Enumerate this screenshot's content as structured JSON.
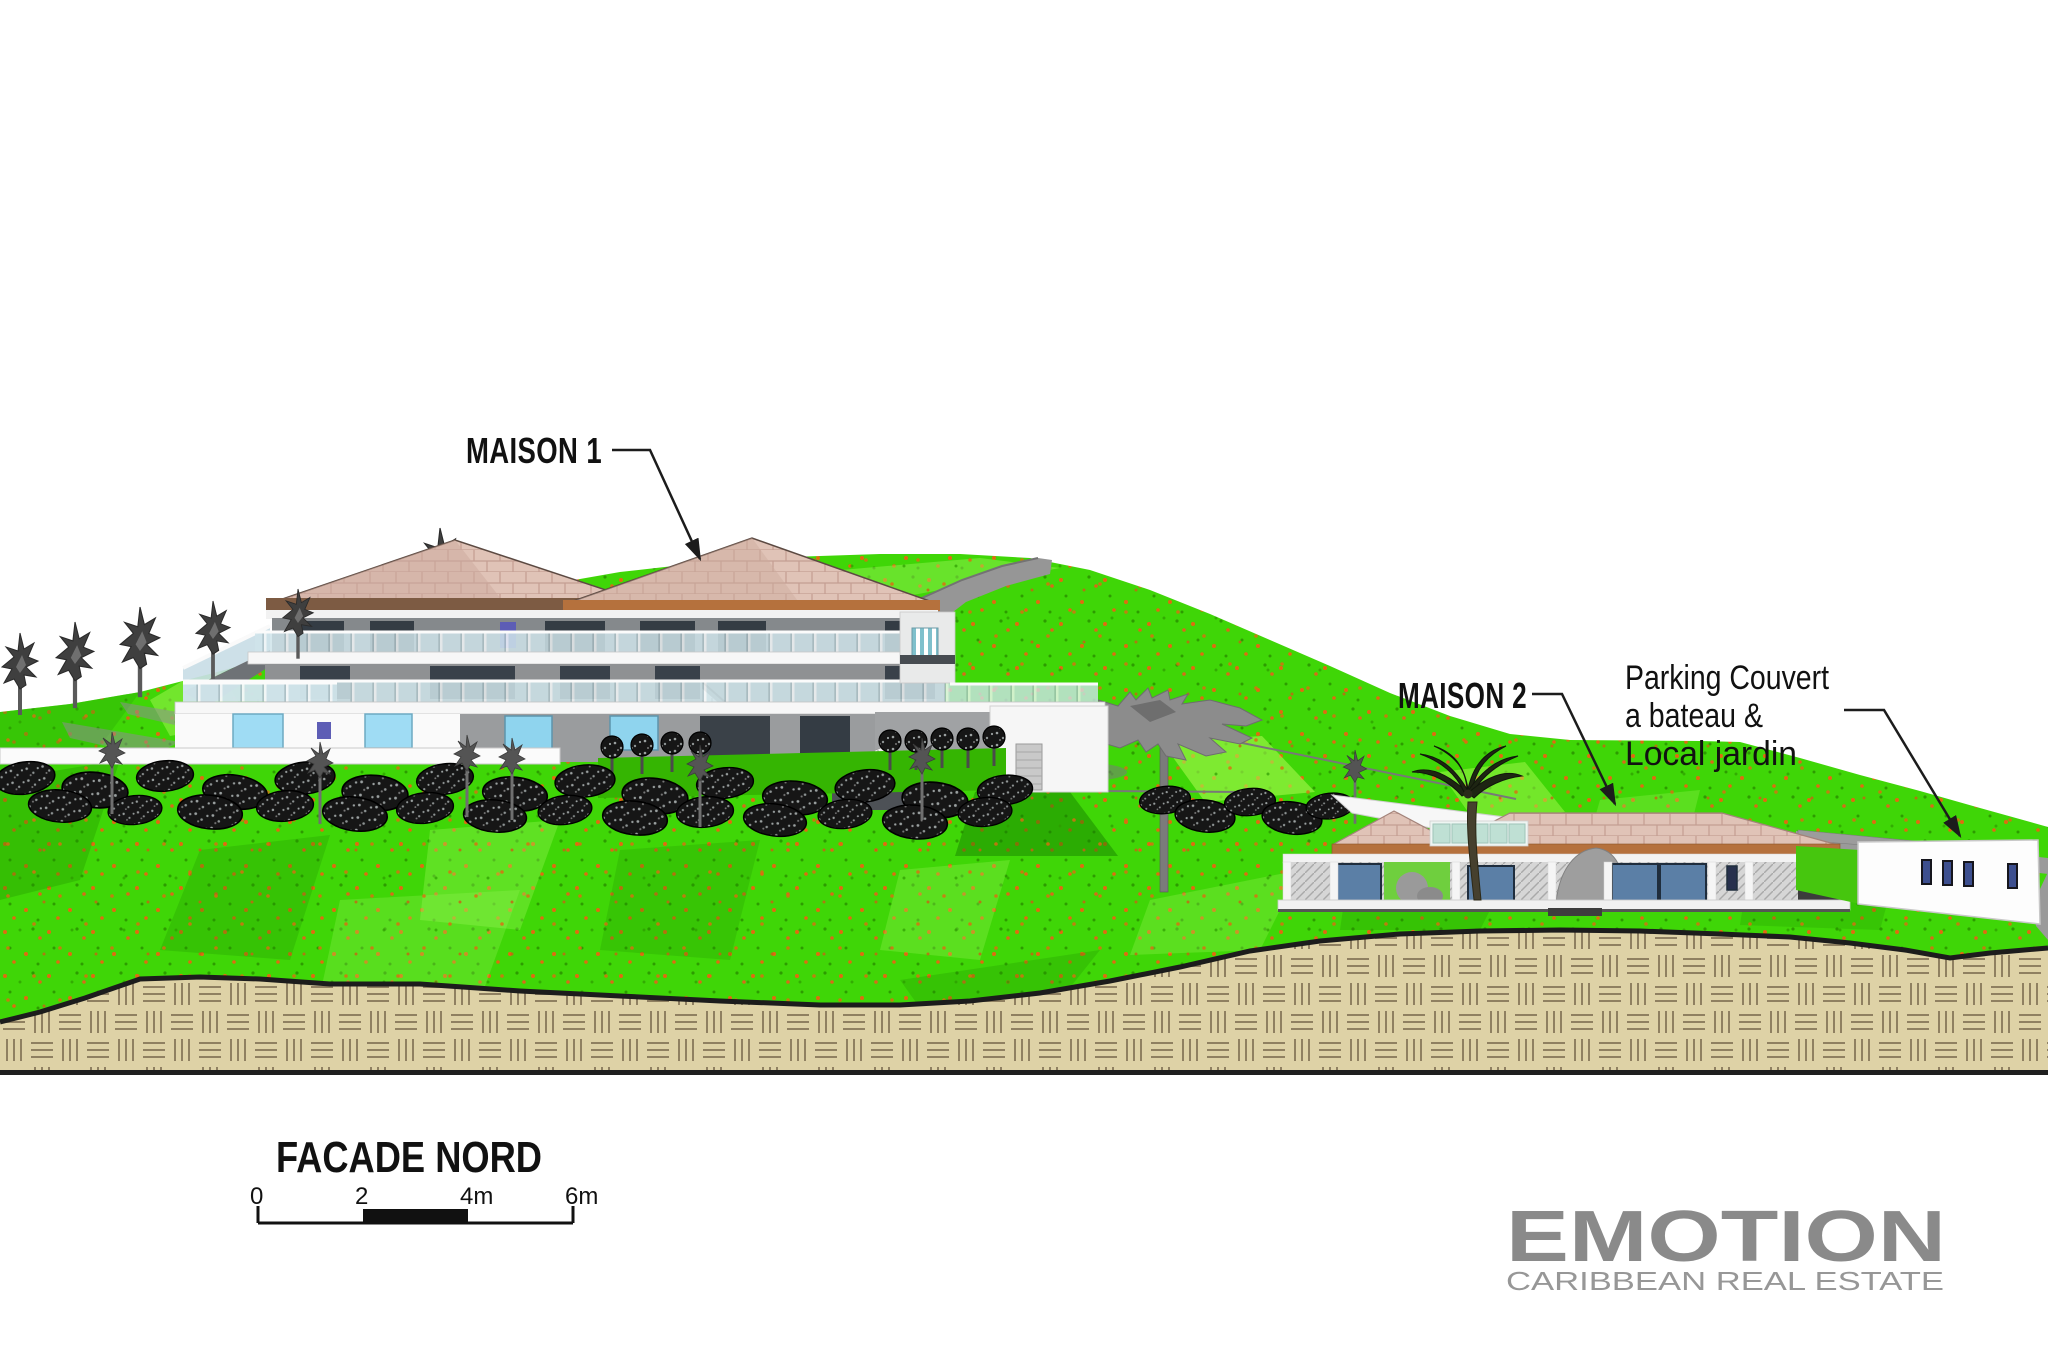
{
  "drawing": {
    "type": "architectural-elevation",
    "title_block": {
      "title": "FACADE NORD"
    },
    "annotations": {
      "maison1": {
        "label": "MAISON 1"
      },
      "maison2": {
        "label": "MAISON 2"
      },
      "parking": {
        "line1": "Parking Couvert",
        "line2": "a bateau &",
        "line3": "Local jardin"
      }
    },
    "scale_bar": {
      "ticks": [
        "0",
        "2",
        "4m",
        "6m"
      ],
      "unit": "m"
    },
    "logo": {
      "name": "EMOTION",
      "tagline": "CARIBBEAN REAL ESTATE"
    },
    "palette": {
      "sky": "#ffffff",
      "grass_main": "#3fd607",
      "grass_light": "#9bf558",
      "grass_dark": "#1d8a00",
      "grass_speckle_orange": "#e06a10",
      "roof_pink": "#e0c3b7",
      "roof_joint": "#c49e92",
      "fascia_brown": "#7d5b43",
      "fascia_orange": "#b5713d",
      "wall_gray": "#85898c",
      "wall_white": "#fafafa",
      "window_dark": "#343c44",
      "window_blue": "#9fdcf4",
      "window_violet": "#5d5db5",
      "window_steelblue": "#5b7fa6",
      "soil_tan": "#ded2a6",
      "soil_hatch": "#8f8061",
      "rock_black": "#161616",
      "driveway_gray": "#969696",
      "logo_gray": "#8a8a8a",
      "line_black": "#1c1c1c"
    }
  }
}
